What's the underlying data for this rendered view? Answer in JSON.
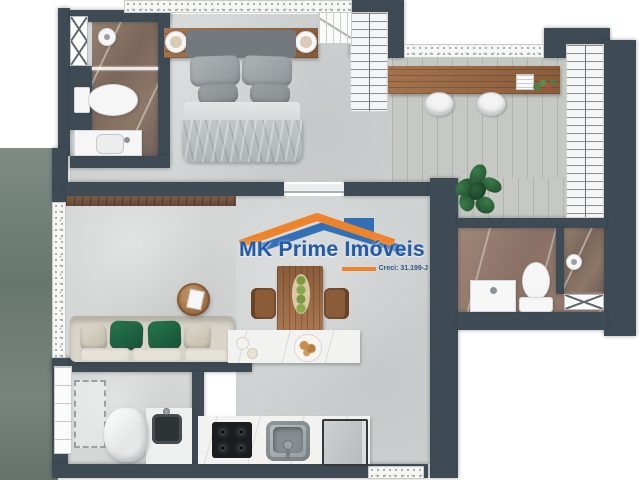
{
  "watermark": {
    "brand": "MK Prime Imóveis",
    "creci": "Creci: 31.199-J",
    "brand_color": "#1d57a7",
    "roof_orange": "#ef8125",
    "roof_blue": "#2e6cb5"
  },
  "palette": {
    "wall": "#3e4a54",
    "floor_light": "#cfd2d2",
    "floor_wood": "#c6c9c3",
    "bath_marble_dark": "#8d7767",
    "bath_marble_pink": "#997f72",
    "furniture_wood": "#9a6a46",
    "sofa_green_pillow": "#1e6b43",
    "plant_green": "#2c5d38",
    "counter_white": "#f2f2f0"
  },
  "furniture_icons": [
    "double-bed",
    "nightstand-tray",
    "headboard",
    "closet-hangers",
    "wardrobe-hangers",
    "desk",
    "desk-chair",
    "notepad",
    "flowers",
    "potted-plant",
    "toilet",
    "sink-vanity",
    "shower-head",
    "glass-divider",
    "towel-rack",
    "sofa",
    "coffee-table",
    "magazine",
    "tv-panel",
    "dining-table",
    "dining-chair",
    "fruit-tray",
    "kitchen-island",
    "pastry-plate",
    "bowl",
    "cooktop",
    "kitchen-sink",
    "fridge",
    "laundry-sink",
    "laundry-basket",
    "washer-space",
    "shelving",
    "window-glass"
  ]
}
